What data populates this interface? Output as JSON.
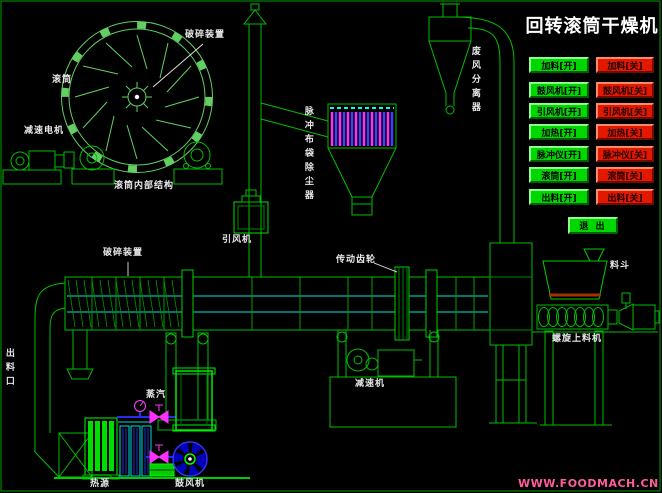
{
  "title": "回转滚筒干燥机",
  "watermark": "WWW.FOODMACH.CN",
  "panel": {
    "rows": [
      {
        "on": "加料[开]",
        "off": "加料[关]"
      },
      {
        "on": "鼓风机[开]",
        "off": "鼓风机[关]"
      },
      {
        "on": "引风机[开]",
        "off": "引风机[关]"
      },
      {
        "on": "加热[开]",
        "off": "加热[关]"
      },
      {
        "on": "脉冲仪[开]",
        "off": "脉冲仪[关]"
      },
      {
        "on": "滚筒[开]",
        "off": "滚筒[关]"
      },
      {
        "on": "出料[开]",
        "off": "出料[关]"
      }
    ],
    "exit_label": "退 出"
  },
  "labels": {
    "crusher_top": "破碎装置",
    "drum_section": "滚筒",
    "reduction_motor": "减速电机",
    "drum_internal": "滚筒内部结构",
    "dust_collector": "脉冲布袋除尘器",
    "induced_fan": "引风机",
    "waste_air_separator": "废风分离器",
    "crusher_main": "破碎装置",
    "transmission_gear": "传动齿轮",
    "reducer": "减速机",
    "hopper": "料斗",
    "screw_feeder": "螺旋上料机",
    "steam": "蒸汽",
    "heat_source": "热源",
    "blower": "鼓风机",
    "discharge_outlet": "出料口"
  },
  "colors": {
    "line_green": "#00be00",
    "bright_green": "#00ff00",
    "cyan": "#00ffff",
    "magenta": "#ff30ff",
    "pipe_blue": "#2a2aee",
    "button_green": "#00d600",
    "button_red": "#e31800",
    "hopper_level": "#a53000",
    "watermark_pink": "#ff5c9e",
    "label_white": "#e8e8e8",
    "title_white": "#ffffff"
  }
}
